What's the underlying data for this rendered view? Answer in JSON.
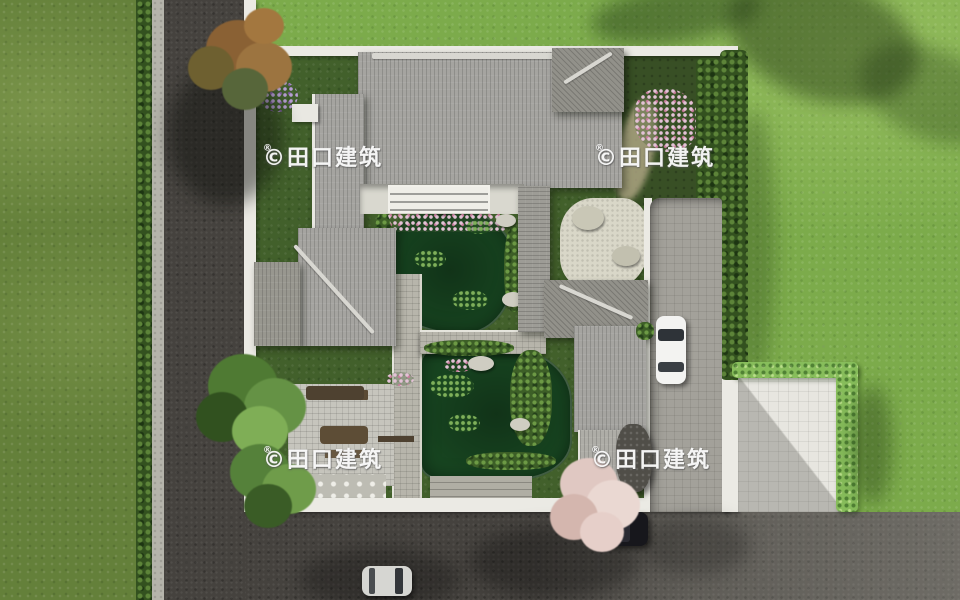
{
  "watermark": {
    "text": "©田口建筑",
    "registered": "®"
  },
  "palette": {
    "lawn_outer": "#7cab4b",
    "lawn_west": "#64803a",
    "courtyard_grass": "#42602b",
    "road_asphalt": "#45423e",
    "road_light": "#6e6a63",
    "wall_white": "#ebeae4",
    "roof_tile_gray": "#a5a4a0",
    "pond_green": "#174420",
    "hedge_bright": "#87bd5b",
    "hedge_dark": "#33511f",
    "blossom_pink": "#e3cdc7",
    "autumn_foliage": "#93683a",
    "stone_paving": "#b7b5ab",
    "driveway_gray": "#a3a19a",
    "car_white": "#f3f3f1",
    "car_silver": "#d6d6d2",
    "car_dark": "#17171c"
  },
  "scene": {
    "view": "top-down aerial rendering",
    "objects": [
      "walled courtyard residence",
      "main house gray tile roof",
      "west wing",
      "east wing",
      "covered walkways",
      "north pond",
      "south pond",
      "stone bridge",
      "rock garden patio",
      "southwest patio with furniture",
      "east driveway",
      "entry forecourt",
      "white car in driveway",
      "silver car on road",
      "dark car parked at curb",
      "pink blossom tree",
      "autumn tree",
      "green courtyard trees",
      "perimeter hedges",
      "asphalt roads",
      "lawns"
    ]
  }
}
